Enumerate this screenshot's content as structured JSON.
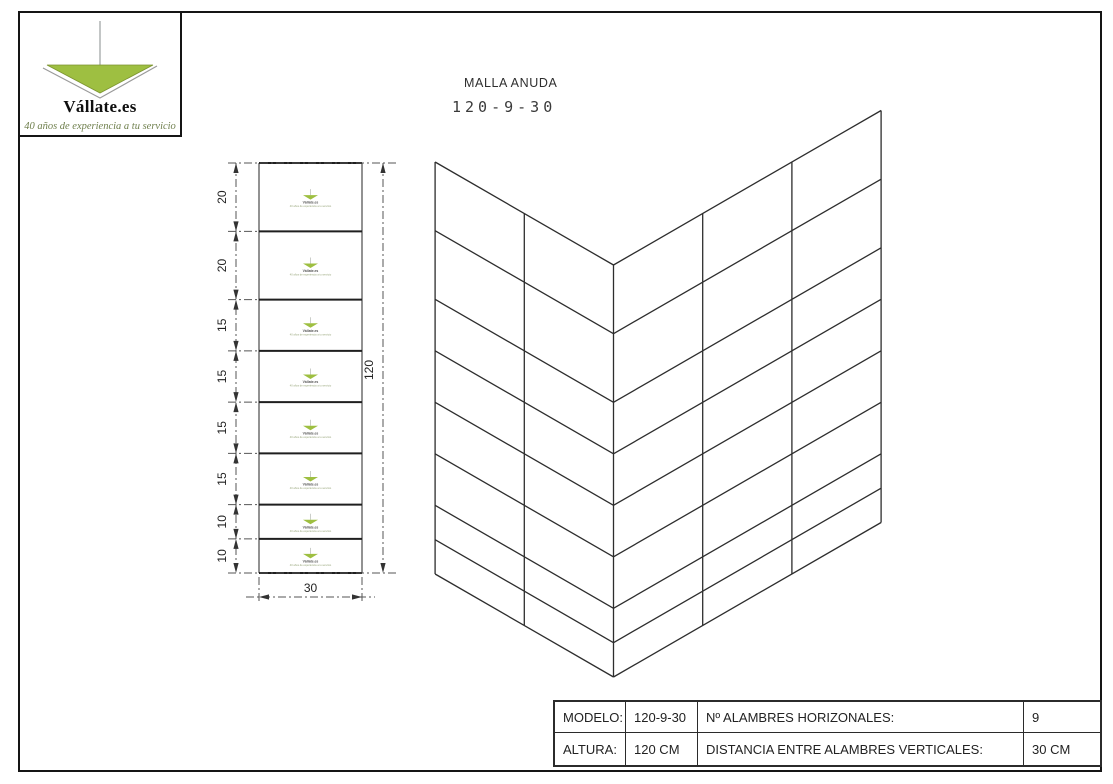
{
  "logo": {
    "brand": "Vállate.es",
    "tagline": "40 años de experiencia a tu servicio",
    "green": "#9ebf41"
  },
  "title": {
    "line1": "MALLA ANUDA",
    "line2": "120-9-30"
  },
  "spec_table": {
    "rows": [
      {
        "cells": [
          "MODELO:",
          "120-9-30",
          "Nº ALAMBRES HORIZONALES:",
          "9"
        ]
      },
      {
        "cells": [
          "ALTURA:",
          "120 CM",
          "DISTANCIA ENTRE ALAMBRES VERTICALES:",
          "30 CM"
        ]
      }
    ]
  },
  "diagram": {
    "type": "technical-drawing",
    "front_view": {
      "row_heights_cm": [
        20,
        20,
        15,
        15,
        15,
        15,
        10,
        10
      ],
      "row_labels": [
        "20",
        "20",
        "15",
        "15",
        "15",
        "15",
        "10",
        "10"
      ],
      "total_height_label": "120",
      "width_label": "30",
      "width_cm": 30,
      "total_height_cm": 120
    },
    "iso_view": {
      "horizontal_wires": 9,
      "left_panel_columns": 2,
      "right_panel_columns": 3,
      "column_width_cm": 30
    },
    "watermark": {
      "line1": "Vállate.es",
      "line2": "40 años de experiencia a tu servicio"
    }
  }
}
